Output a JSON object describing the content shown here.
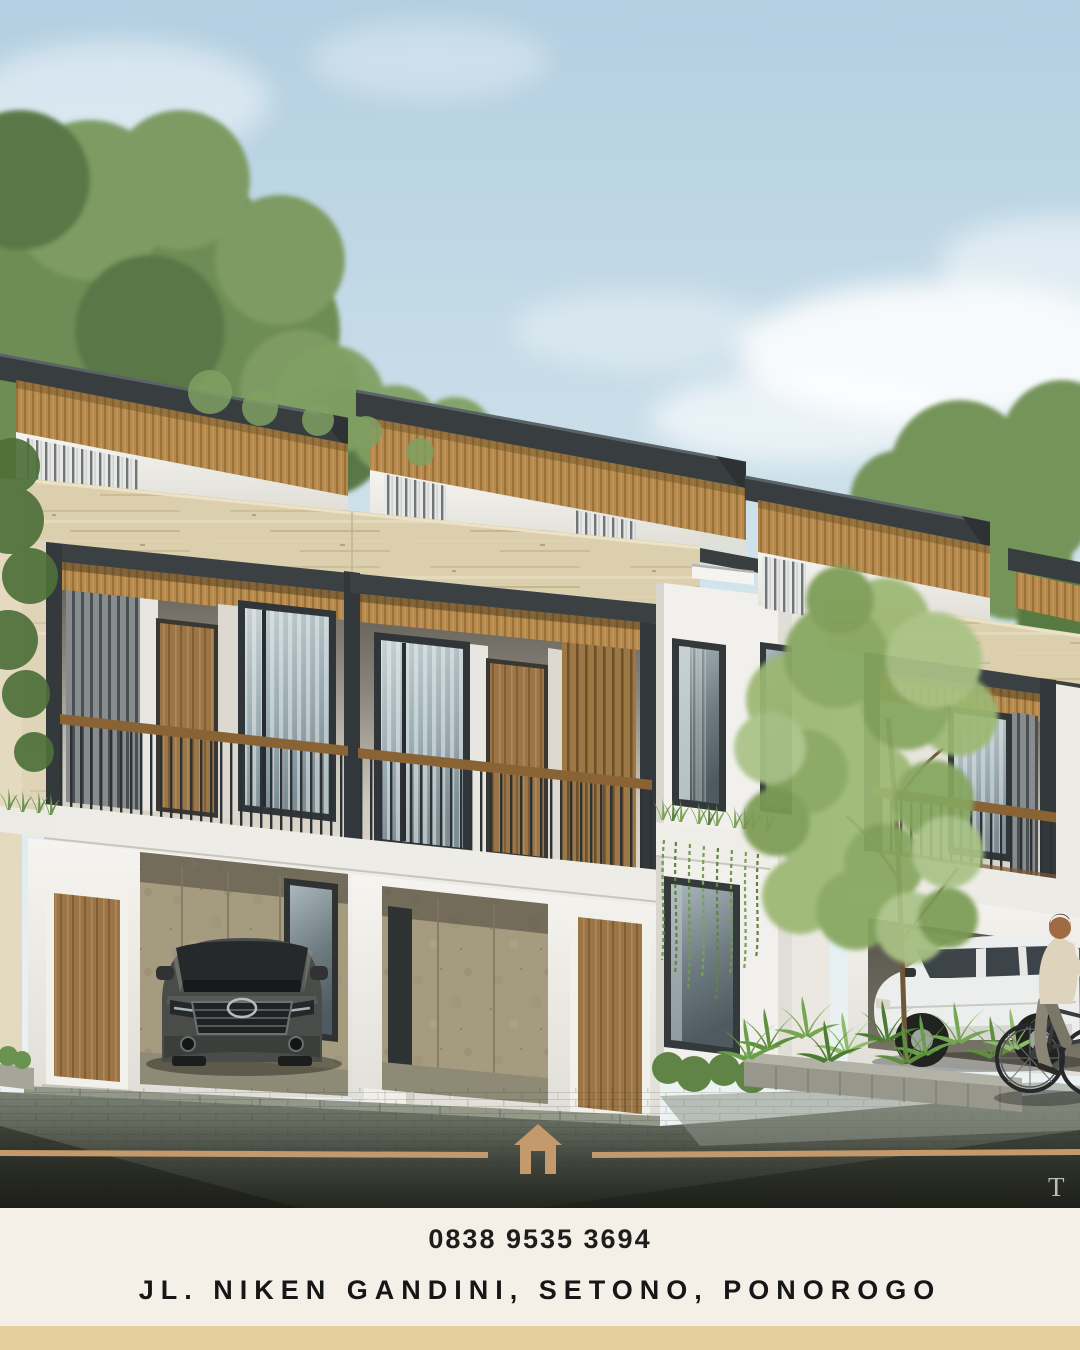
{
  "footer": {
    "phone": "0838 9535 3694",
    "address": "JL. NIKEN GANDINI, SETONO, PONOROGO"
  },
  "watermark": "T",
  "icons": {
    "road_marker": "house-icon"
  },
  "colors": {
    "accent_tan": "#C49A6C",
    "footer_background": "#F5F0E7",
    "footer_band": "#E5CF9D",
    "text": "#1B1B1B",
    "sky_top": "#B3CFE1",
    "roof_charcoal": "#383D3F",
    "wood_soffit": "#B5894C",
    "travertine": "#DBCFAD",
    "carport_stone": "#A59C80",
    "foliage": "#6E8C55",
    "road_dark": "#23261E"
  }
}
